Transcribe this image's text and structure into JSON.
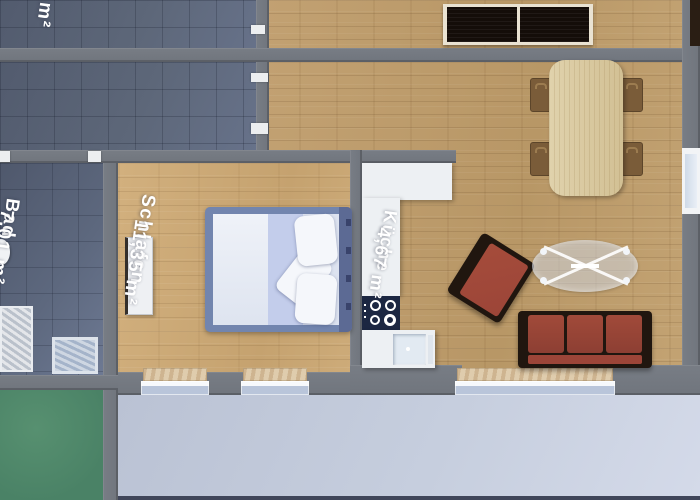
{
  "floorplan": {
    "type": "apartment-top-view-render",
    "rooms": {
      "flur": {
        "name": "Flur",
        "area": "4 m²"
      },
      "bad": {
        "name": "Bad",
        "area": "7,01 m²"
      },
      "schlafen": {
        "name": "Schlafen",
        "area": "11,35 m²"
      },
      "kueche": {
        "name": "Küche",
        "area": "4,67 m²"
      }
    }
  },
  "colors": {
    "wall": "#70757d",
    "tile_floor": "#5b6477",
    "wood_floor": "#c2a172",
    "bedroom_floor": "#d2b07e",
    "terrace": "#c6cede",
    "green_floor": "#4f8a6e",
    "sofa_red": "#9c4538",
    "sofa_frame": "#20160f",
    "bed_frame_blue": "#7285ae",
    "duvet_blue": "#c3cdeb",
    "counter_white": "#edf0f3",
    "cooktop_navy": "#1c2742",
    "sill": "#d9c6a6",
    "wardrobe_panel": "#140d09",
    "label_text": "#ffffff"
  }
}
